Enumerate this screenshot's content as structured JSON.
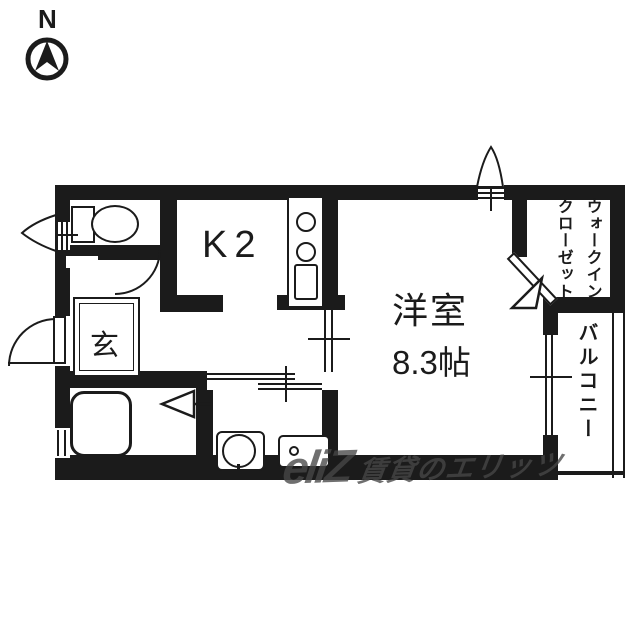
{
  "compass": {
    "north_label": "N"
  },
  "rooms": {
    "kitchen": {
      "label": "K2"
    },
    "western_room": {
      "name": "洋室",
      "size": "8.3帖"
    },
    "entrance": {
      "label": "玄"
    },
    "walk_in_closet": {
      "label_line1": "ウォークイン",
      "label_line2": "クローゼット"
    },
    "balcony": {
      "label": "バルコニー"
    }
  },
  "watermark": {
    "logo": "eliZ",
    "text": "賃貸のエリッツ"
  },
  "icons": {
    "compass": "compass-north-icon",
    "toilet": "toilet-icon",
    "bathtub": "bathtub-icon",
    "washbasin": "washbasin-icon",
    "washing_machine": "washing-machine-icon",
    "stove": "stove-burners-icon",
    "kitchen_sink": "kitchen-sink-icon",
    "windows": "window-icon",
    "doors": "door-swing-icon"
  },
  "colors": {
    "wall": "#1b1b1b",
    "background": "#ffffff",
    "watermark": "#464646"
  }
}
